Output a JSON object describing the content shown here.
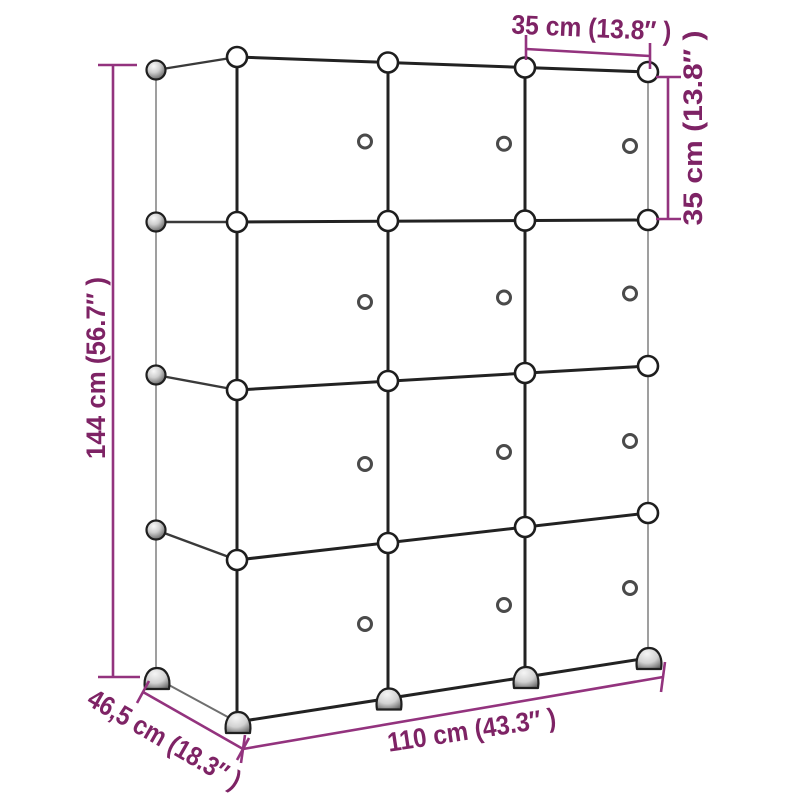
{
  "diagram": {
    "type": "product-dimension-diagram",
    "subject": "modular-cube-storage-organizer",
    "labels": {
      "total_height": "144 cm (56.7″ )",
      "total_width": "110 cm (43.3″ )",
      "depth": "46,5 cm (18.3″ )",
      "cube_width": "35 cm (13.8″ )",
      "cube_height": "35 cm (13.8″ )"
    },
    "measurements": {
      "total_height_cm": 144,
      "total_width_cm": 110,
      "depth_cm": 46.5,
      "cube_width_cm": 35,
      "cube_height_cm": 35,
      "total_height_in": 56.7,
      "total_width_in": 43.3,
      "depth_in": 18.3,
      "cube_width_in": 13.8,
      "cube_height_in": 13.8
    },
    "structure": {
      "columns": 3,
      "rows": 4,
      "cube_count": 12,
      "door_knob_count": 12
    },
    "colors": {
      "dimension_line": "#93337e",
      "dimension_text": "#7e2365",
      "structure_dark": "#222222",
      "structure_light": "#9f9f9f",
      "background": "#ffffff"
    }
  }
}
